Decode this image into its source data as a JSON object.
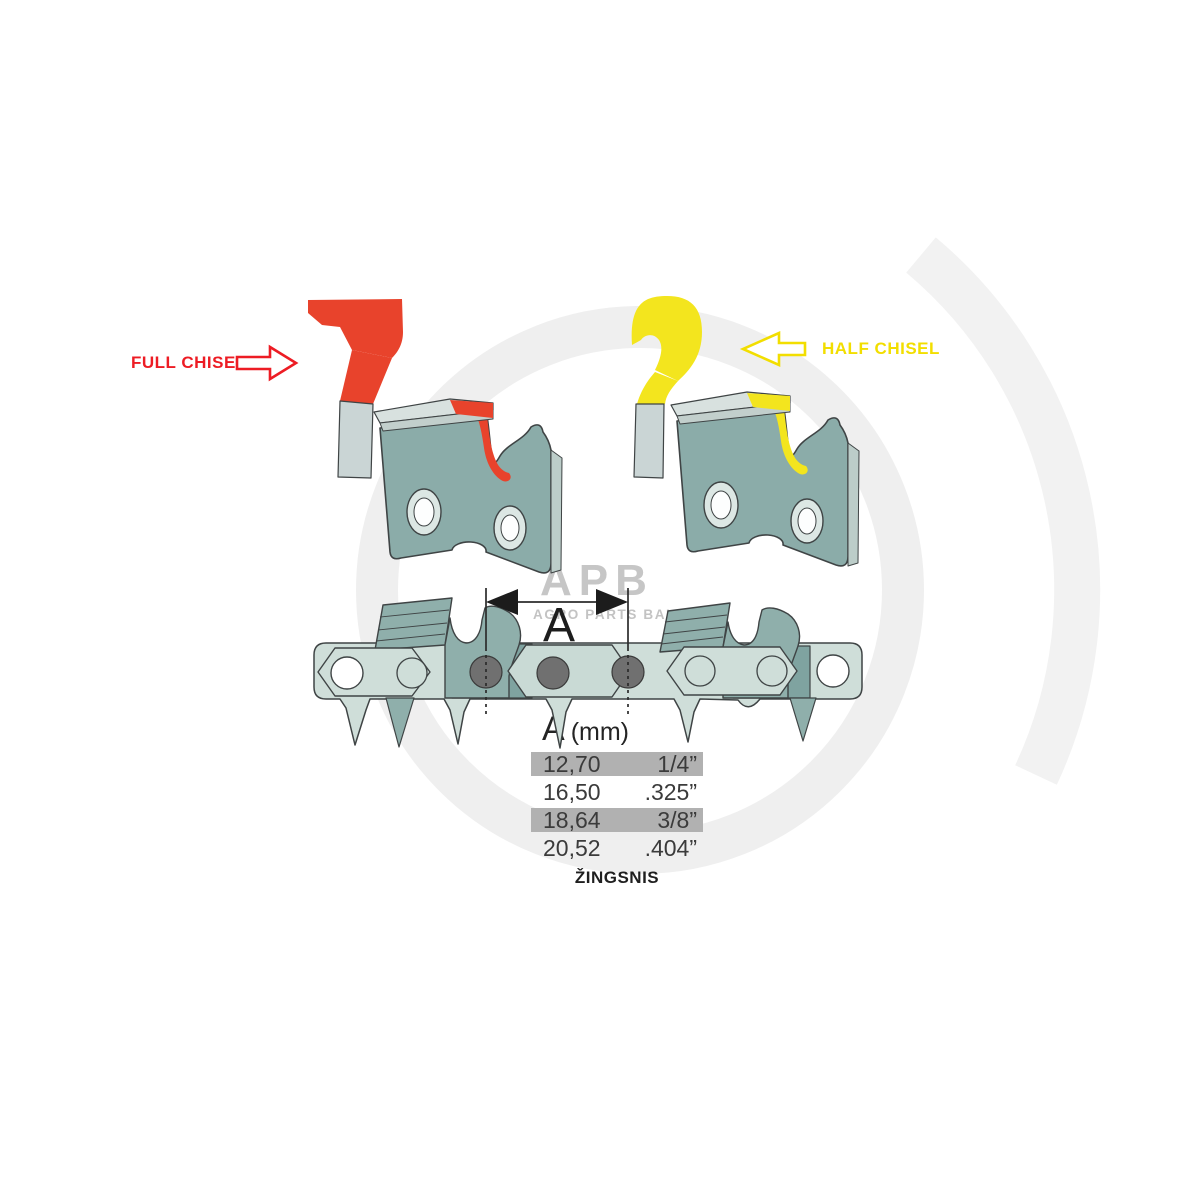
{
  "labels": {
    "full_chisel": "FULL CHISEL",
    "half_chisel": "HALF CHISEL",
    "dimension_letter": "A",
    "pitch_caption": "ŽINGSNIS"
  },
  "table": {
    "header_letter": "A",
    "header_unit": "(mm)",
    "rows": [
      {
        "mm": "12,70",
        "inch": "1/4”"
      },
      {
        "mm": "16,50",
        "inch": ".325”"
      },
      {
        "mm": "18,64",
        "inch": "3/8”"
      },
      {
        "mm": "20,52",
        "inch": ".404”"
      }
    ]
  },
  "watermark": {
    "abbr": "APB",
    "name": "AGRO PARTS BALTIJA"
  },
  "colors": {
    "red_text": "#ed1c24",
    "red_fill": "#e8432c",
    "yellow_text": "#f2de00",
    "yellow_fill": "#f3e51e",
    "link_body": "#8baca9",
    "chain_cutter": "#8fafab",
    "chain_band": "#cfded9",
    "chain_band_mid": "#c9dad5",
    "plate_gray_top": "#d8e1df",
    "plate_gray_front": "#c2cfcc",
    "stem_gray": "#cad5d5",
    "hole_ring": "#dce7e4",
    "rivet_dark": "#707070",
    "side_face": "#bccdc9",
    "dim_black": "#1c1c1c"
  }
}
